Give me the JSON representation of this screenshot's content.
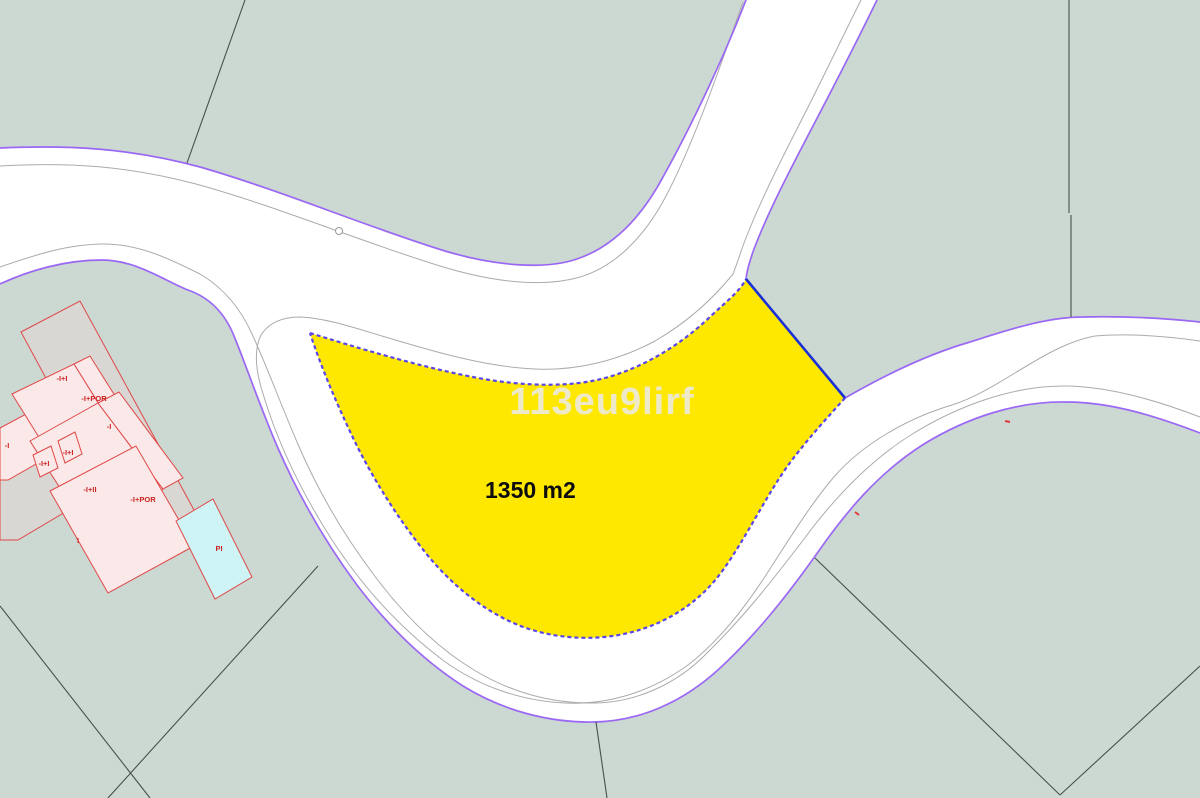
{
  "map": {
    "kind": "cadastral-parcel-map",
    "watermark": "113eu9lirf",
    "highlight_parcel": {
      "area_label": "1350 m2",
      "fill": "#ffe800",
      "border_color": "#5a46e8",
      "ne_edge_color": "#1b2fd6"
    },
    "building_labels": [
      {
        "text": "-I+I",
        "x": 62,
        "y": 381
      },
      {
        "text": "-I+POR",
        "x": 94,
        "y": 401
      },
      {
        "text": "-I",
        "x": 109,
        "y": 429
      },
      {
        "text": "-I",
        "x": 7,
        "y": 448
      },
      {
        "text": "-I+I",
        "x": 68,
        "y": 455
      },
      {
        "text": "-I+I",
        "x": 44,
        "y": 466
      },
      {
        "text": "-I+II",
        "x": 90,
        "y": 492
      },
      {
        "text": "-I+POR",
        "x": 143,
        "y": 502
      },
      {
        "text": "I",
        "x": 78,
        "y": 543
      },
      {
        "text": "PI",
        "x": 219,
        "y": 551
      }
    ],
    "colors": {
      "background_green": "#ccd8d2",
      "road_white": "#ffffff",
      "road_edge_purple": "#9b68f5",
      "curb_gray": "#ababab",
      "parcel_boundary_dark": "#46514a",
      "building_outline_red": "#e04848",
      "building_fill_pink": "#fbe8e8",
      "building_parcel_gray": "#d8d7d4",
      "pool_fill_cyan": "#cff4f6",
      "area_text_black": "#0d0d0d",
      "watermark_gray": "#ecebe5"
    }
  }
}
